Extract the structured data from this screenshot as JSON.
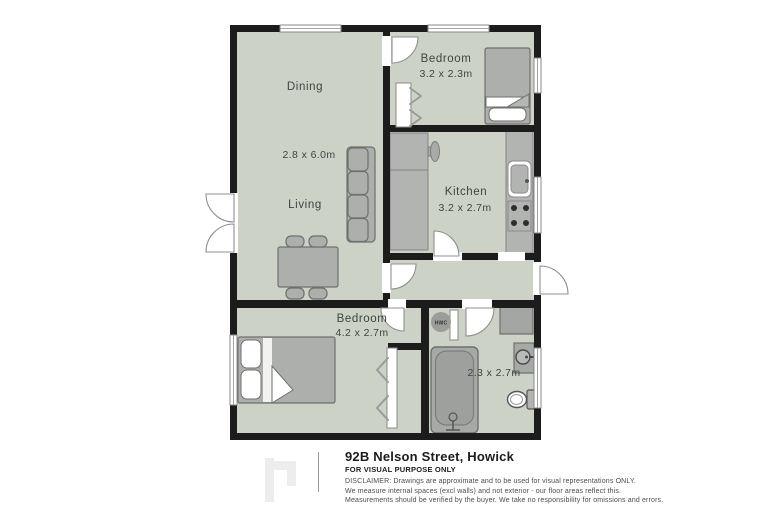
{
  "plan": {
    "rooms": {
      "dining": {
        "label": "Dining"
      },
      "living": {
        "label": "Living",
        "dims": "2.8 x 6.0m"
      },
      "bedroom_small": {
        "label": "Bedroom",
        "dims": "3.2 x 2.3m"
      },
      "kitchen": {
        "label": "Kitchen",
        "dims": "3.2 x 2.7m"
      },
      "bedroom_main": {
        "label": "Bedroom",
        "dims": "4.2 x 2.7m"
      },
      "bathroom": {
        "dims": "2.3 x 2.7m"
      },
      "hwc": {
        "label": "HWC"
      }
    },
    "colors": {
      "floor": "#ccd3c6",
      "wall": "#1c1c1c",
      "furniture_gray": "#adafac",
      "label_text": "#3e4441"
    }
  },
  "footer": {
    "title": "92B Nelson Street, Howick",
    "subtitle": "FOR VISUAL PURPOSE ONLY",
    "disclaimer_lines": [
      "DISCLAIMER:  Drawings are approximate and to be used for visual representations ONLY.",
      "We measure internal spaces (excl walls) and not exterior - our floor areas reflect this.",
      "Measurements should be verified by the buyer. We take no responsibility for omissions and errors."
    ]
  }
}
